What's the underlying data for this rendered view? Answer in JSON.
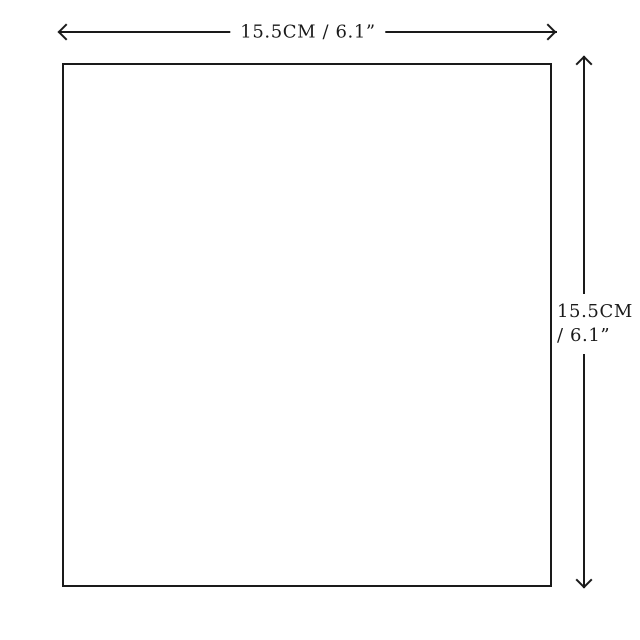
{
  "diagram": {
    "type": "dimension-diagram",
    "shape": "square-outline",
    "width_dimension": {
      "label": "15.5CM / 6.1”",
      "value_cm": 15.5,
      "value_in": 6.1,
      "arrow": "double-headed-horizontal"
    },
    "height_dimension": {
      "label": "15.5CM / 6.1”",
      "line1": "15.5CM",
      "line2": "/ 6.1”",
      "value_cm": 15.5,
      "value_in": 6.1,
      "arrow": "double-headed-vertical"
    },
    "colors": {
      "line": "#1a1a1a",
      "background": "#ffffff"
    }
  }
}
